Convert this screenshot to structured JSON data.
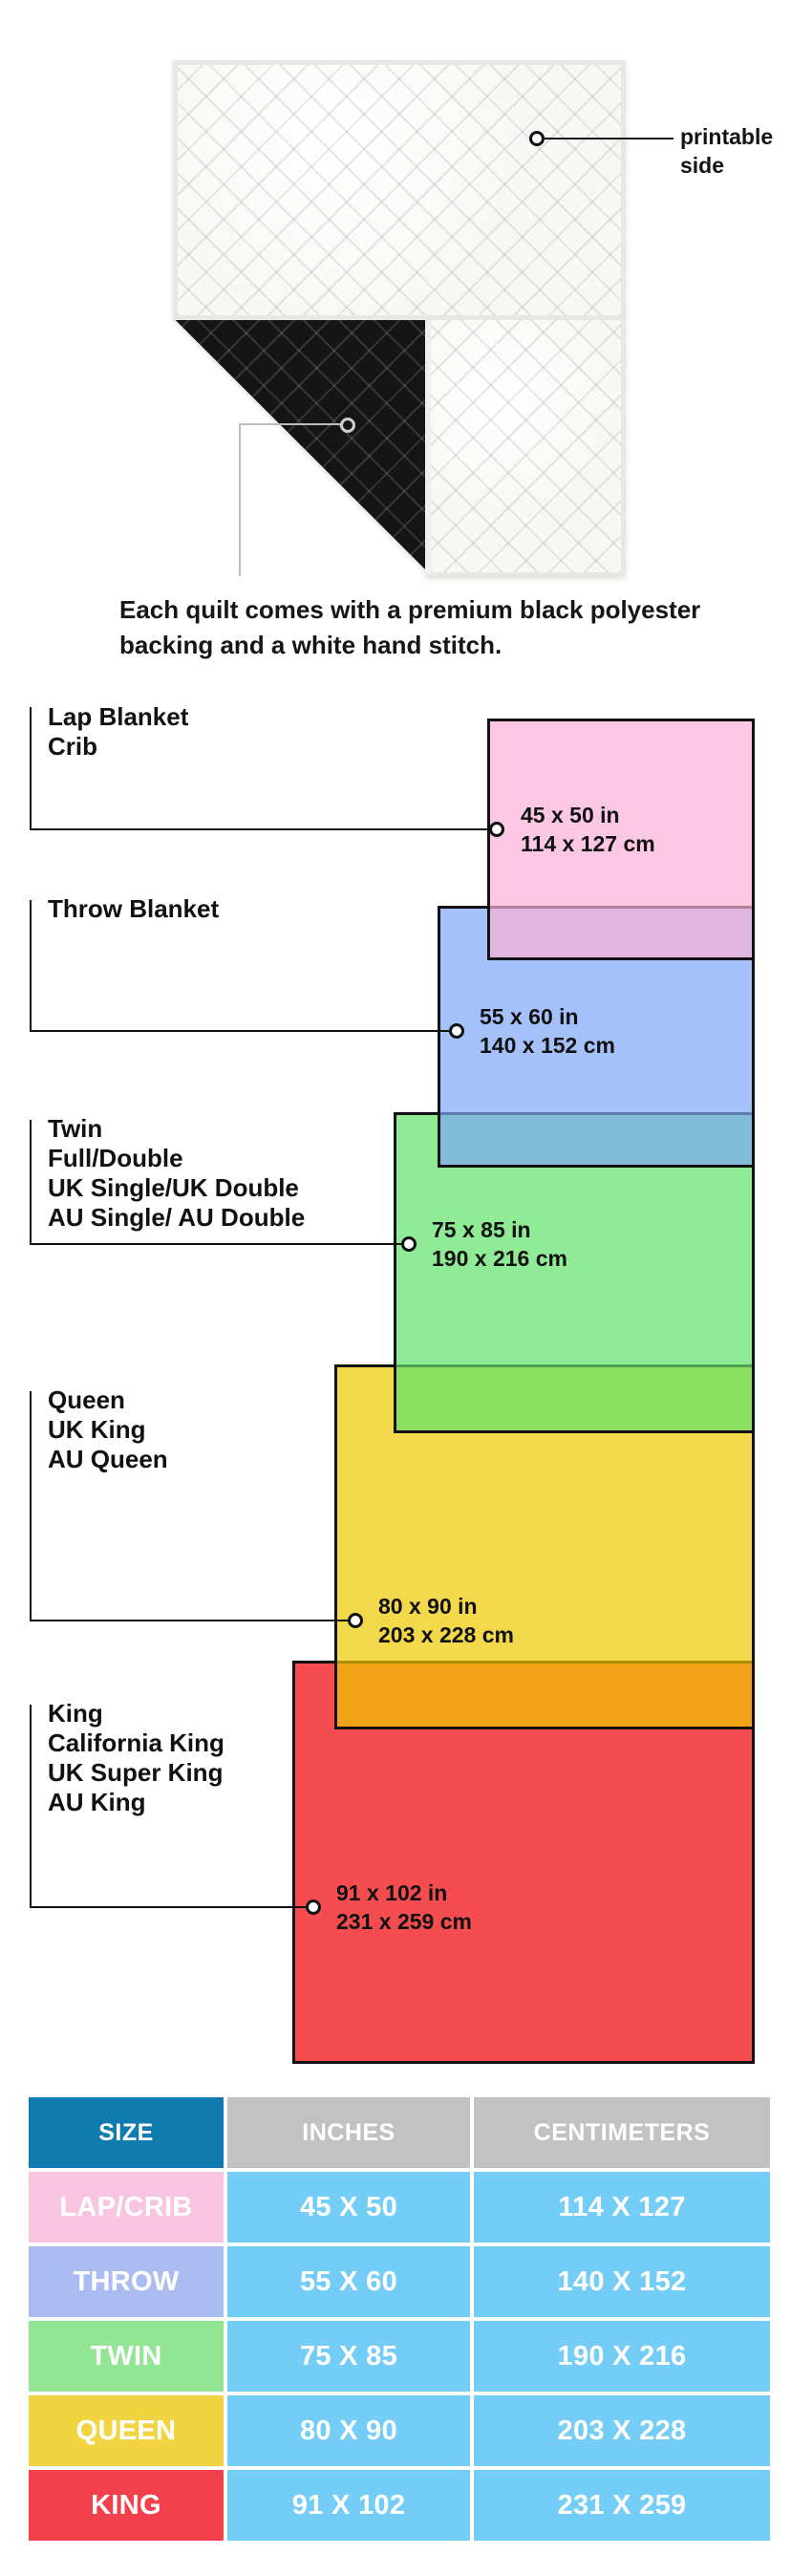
{
  "quilt": {
    "printable_line1": "printable",
    "printable_line2": "side",
    "caption_line1": "Each quilt comes with a premium black polyester",
    "caption_line2": "backing and a white hand stitch.",
    "front_color": "#f7f7f5",
    "back_color": "#151515"
  },
  "diagram": {
    "line_color": "#111111",
    "sizes": [
      {
        "id": "lap",
        "label_lines": [
          "Lap Blanket",
          "Crib"
        ],
        "inches": "45 x 50 in",
        "cm": "114 x 127 cm",
        "fill": "rgba(249,175,215,0.7)"
      },
      {
        "id": "throw",
        "label_lines": [
          "Throw Blanket"
        ],
        "inches": "55 x 60 in",
        "cm": "140 x 152 cm",
        "fill": "rgba(125,168,246,0.7)"
      },
      {
        "id": "twin",
        "label_lines": [
          "Twin",
          "Full/Double",
          "UK Single/UK Double",
          "AU Single/ AU Double"
        ],
        "inches": "75 x 85 in",
        "cm": "190 x 216 cm",
        "fill": "rgba(96,226,106,0.7)"
      },
      {
        "id": "queen",
        "label_lines": [
          "Queen",
          "UK King",
          "AU Queen"
        ],
        "inches": "80 x 90 in",
        "cm": "203 x 228 cm",
        "fill": "rgba(239,199,0,0.7)"
      },
      {
        "id": "king",
        "label_lines": [
          "King",
          "California King",
          "UK Super King",
          "AU King"
        ],
        "inches": "91 x 102 in",
        "cm": "231 x 259 cm",
        "fill": "rgba(239,0,4,0.7)"
      }
    ]
  },
  "table": {
    "headers": [
      "SIZE",
      "INCHES",
      "CENTIMETERS"
    ],
    "header_size_color": "#0f7bae",
    "header_other_color": "#c2c2c2",
    "value_cell_color": "#74cdf6",
    "rows": [
      {
        "size": "LAP/CRIB",
        "inches": "45 X 50",
        "cm": "114 X 127",
        "color": "#f9c4df"
      },
      {
        "size": "THROW",
        "inches": "55 X 60",
        "cm": "140 X 152",
        "color": "#abbcf2"
      },
      {
        "size": "TWIN",
        "inches": "75 X 85",
        "cm": "190 X 216",
        "color": "#92e593"
      },
      {
        "size": "QUEEN",
        "inches": "80 X 90",
        "cm": "203 X 228",
        "color": "#f2d443"
      },
      {
        "size": "KING",
        "inches": "91 X 102",
        "cm": "231 X 259",
        "color": "#f4404b"
      }
    ]
  }
}
